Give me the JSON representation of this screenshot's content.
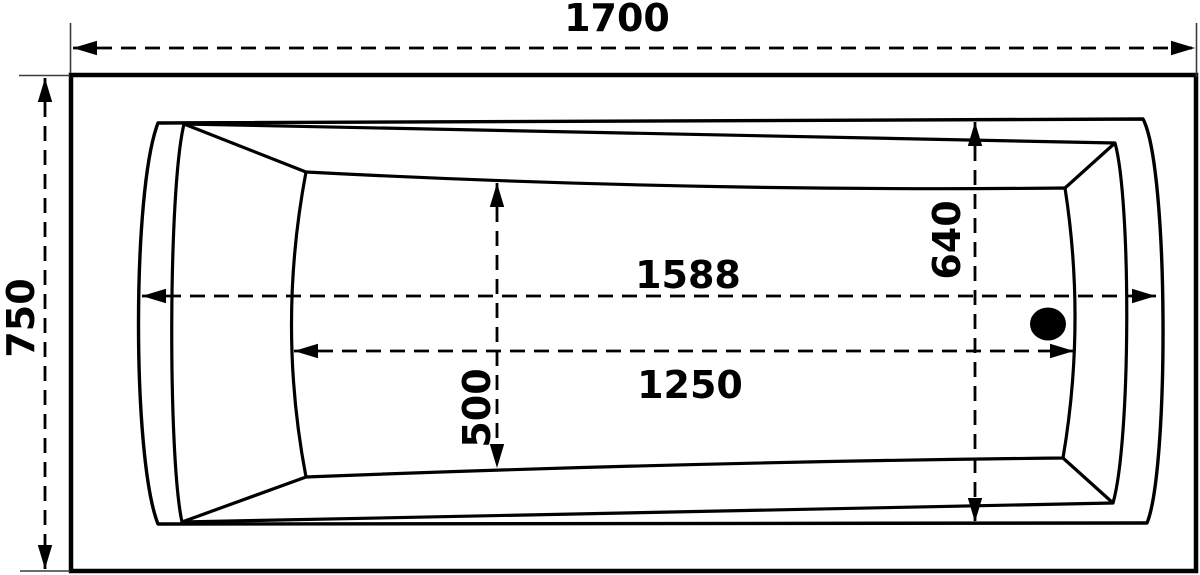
{
  "drawing": {
    "type": "bathtub-top-view-technical-drawing",
    "colors": {
      "background": "#ffffff",
      "line": "#000000",
      "extension_line": "#3a3a3a"
    },
    "dimensions": {
      "overall_length": "1700",
      "overall_width": "750",
      "rim_span": "1588",
      "basin_length": "1250",
      "basin_width": "500",
      "rim_width": "640"
    }
  }
}
